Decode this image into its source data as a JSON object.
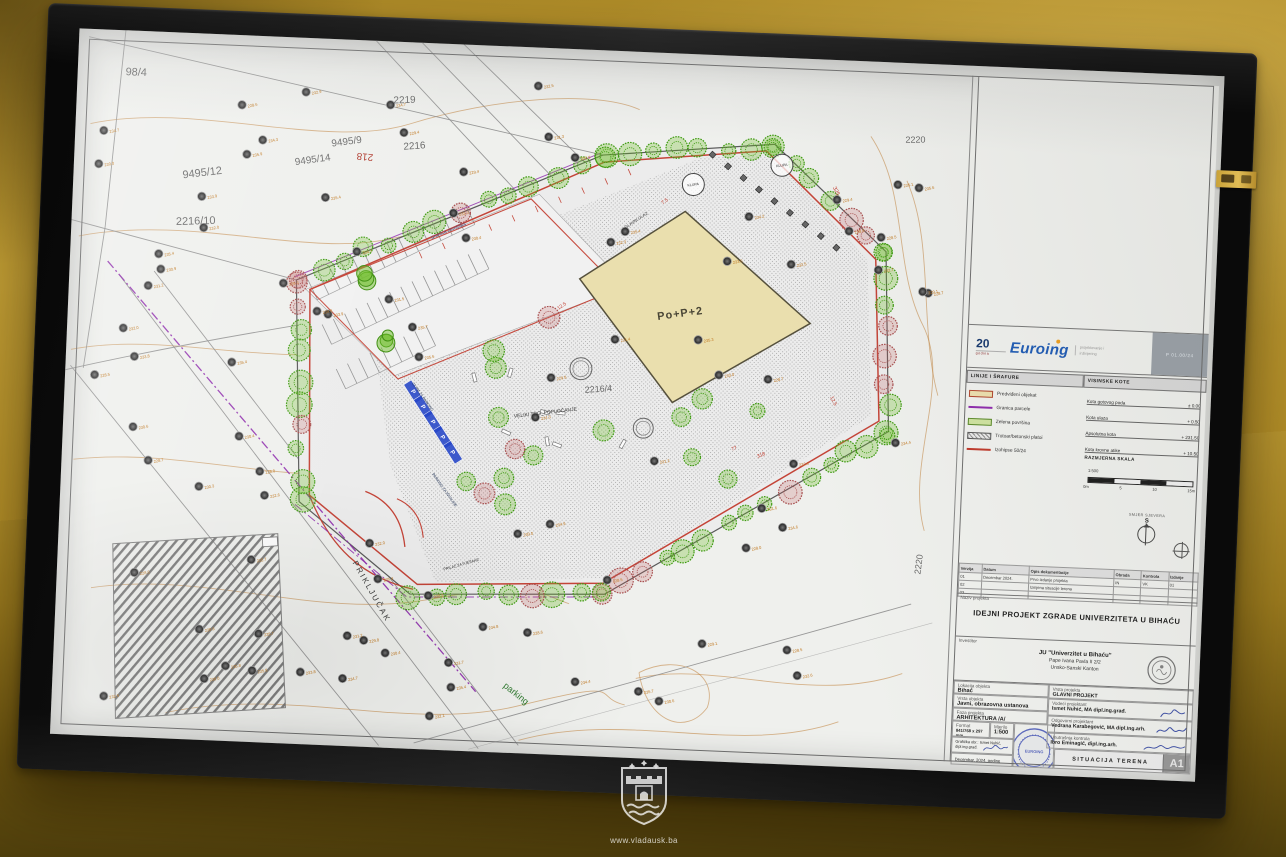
{
  "photo": {
    "watermark_url": "www.vladausk.ba"
  },
  "plan": {
    "building_label": "Po+P+2",
    "labels": [
      {
        "t": "98/4",
        "x": 48,
        "y": 45,
        "r": 0,
        "s": 11,
        "c": "#6a6a6a"
      },
      {
        "t": "2219",
        "x": 318,
        "y": 62,
        "r": -4,
        "s": 10,
        "c": "#6a6a6a"
      },
      {
        "t": "9495/9",
        "x": 258,
        "y": 108,
        "r": -10,
        "s": 10,
        "c": "#6a6a6a"
      },
      {
        "t": "218",
        "x": 300,
        "y": 114,
        "r": 183,
        "s": 10,
        "c": "#b03a2e"
      },
      {
        "t": "2216",
        "x": 330,
        "y": 108,
        "r": -6,
        "s": 10,
        "c": "#6a6a6a"
      },
      {
        "t": "9495/14",
        "x": 222,
        "y": 128,
        "r": -10,
        "s": 10,
        "c": "#6a6a6a"
      },
      {
        "t": "9495/12",
        "x": 110,
        "y": 146,
        "r": -9,
        "s": 11,
        "c": "#6a6a6a"
      },
      {
        "t": "2216/10",
        "x": 105,
        "y": 193,
        "r": -4,
        "s": 11,
        "c": "#6a6a6a"
      },
      {
        "t": "2216/4",
        "x": 522,
        "y": 344,
        "r": -6,
        "s": 9,
        "c": "#6a6a6a"
      },
      {
        "t": "2220",
        "x": 833,
        "y": 80,
        "r": -3,
        "s": 9,
        "c": "#6a6a6a"
      },
      {
        "t": "2220",
        "x": 866,
        "y": 512,
        "r": -85,
        "s": 9,
        "c": "#6a6a6a"
      },
      {
        "t": "PRIKLJUČAK",
        "x": 296,
        "y": 524,
        "r": 58,
        "s": 8,
        "c": "#3c3c3c",
        "ls": 2
      },
      {
        "t": "parking",
        "x": 452,
        "y": 642,
        "r": 36,
        "s": 9,
        "c": "#2f7a2f"
      },
      {
        "t": "VELIKI TRG_POPLOČANJE",
        "x": 452,
        "y": 372,
        "r": -9,
        "s": 5,
        "c": "#3a3a3a"
      },
      {
        "t": "KLUPA",
        "x": 622,
        "y": 132,
        "r": -10,
        "s": 3.6,
        "c": "#333333",
        "circ": 11
      },
      {
        "t": "KLUPA",
        "x": 710,
        "y": 109,
        "r": -10,
        "s": 3.6,
        "c": "#333333",
        "circ": 11
      },
      {
        "t": "granica zemljišta",
        "x": 362,
        "y": 196,
        "r": -24,
        "s": 5,
        "c": "#5a4a7a"
      },
      {
        "t": "PARKING ZA INVALIDE",
        "x": 372,
        "y": 432,
        "r": 52,
        "s": 3.8,
        "c": "#223355"
      },
      {
        "t": "23 PM ZA PARKING",
        "x": 348,
        "y": 342,
        "r": 52,
        "s": 3.8,
        "c": "#223355"
      },
      {
        "t": "PRILAZ ZA PJEŠAKE",
        "x": 388,
        "y": 528,
        "r": -18,
        "s": 3.8,
        "c": "#333333"
      },
      {
        "t": "GLAVNI ULAZ",
        "x": 556,
        "y": 178,
        "r": -36,
        "s": 4.2,
        "c": "#333333"
      },
      {
        "t": "12.5",
        "x": 492,
        "y": 262,
        "r": -36,
        "s": 5,
        "c": "#c0392b"
      },
      {
        "t": "12.5",
        "x": 768,
        "y": 338,
        "r": 62,
        "s": 5,
        "c": "#c0392b"
      },
      {
        "t": "325",
        "x": 762,
        "y": 128,
        "r": 62,
        "s": 5.5,
        "c": "#c0392b"
      },
      {
        "t": "318",
        "x": 698,
        "y": 402,
        "r": -24,
        "s": 5,
        "c": "#c0392b"
      },
      {
        "t": "77",
        "x": 672,
        "y": 396,
        "r": -24,
        "s": 5,
        "c": "#c0392b"
      },
      {
        "t": "7.5",
        "x": 592,
        "y": 152,
        "r": -36,
        "s": 5,
        "c": "#c0392b"
      },
      {
        "t": "Po+P+2",
        "x": 592,
        "y": 268,
        "r": -10,
        "s": 11,
        "c": "#4a4636",
        "w": "bold",
        "ls": 1
      }
    ]
  },
  "titleblock": {
    "logo": {
      "years": "20",
      "years_caption": "godina",
      "brand": "Euroing",
      "tagline_line1": "projektovanje i",
      "tagline_line2": "inžinjering",
      "doc_no": "P 01.00/24"
    },
    "legend": {
      "header": "LINIJE I ŠRAFURE",
      "items": [
        {
          "label": "Predviđeni objekat",
          "swatch": "building"
        },
        {
          "label": "Granica parcele",
          "swatch": "purple-line"
        },
        {
          "label": "Zelena površina",
          "swatch": "green"
        },
        {
          "label": "Trotoar/betonski platoi",
          "swatch": "hatch"
        },
        {
          "label": "Izohipse 50/24",
          "swatch": "red-line"
        }
      ]
    },
    "kote": {
      "header": "VISINSKE KOTE",
      "rows": [
        {
          "label": "Kota gotovog poda",
          "value": "± 0.00"
        },
        {
          "label": "Kota ulaza",
          "value": "+ 0.50"
        },
        {
          "label": "Apsolutna kota",
          "value": "+ 231.50"
        },
        {
          "label": "Kota krovne atike",
          "value": "+ 10.50"
        }
      ],
      "scale_header": "RAZMJERNA SKALA",
      "ratio": "1:500",
      "ticks": [
        "0m",
        "5",
        "10",
        "15m"
      ]
    },
    "north": {
      "caption": "SMJER SJEVERA",
      "letter": "S"
    },
    "revisions": {
      "headers": [
        "Verzija",
        "Datum",
        "Opis dokumentacije",
        "Obrada",
        "Kontrola",
        "Izdanje"
      ],
      "rows": [
        [
          "01",
          "Decembar 2024.",
          "Prvo izdanje projekta",
          "IN",
          "VK",
          "01"
        ],
        [
          "02",
          "",
          "Izmjena situacije terena",
          "",
          "",
          ""
        ],
        [
          "03",
          "",
          "",
          "",
          "",
          ""
        ]
      ]
    },
    "project": {
      "caption": "Naziv projekta",
      "title": "IDEJNI PROJEKT ZGRADE UNIVERZITETA U BIHAĆU"
    },
    "investor": {
      "caption": "Investitor",
      "line1": "JU \"Univerzitet u Bihaću\"",
      "line2": "Pape Ivana Pavla II 2/2",
      "line3": "Unsko-Sanski Kanton"
    },
    "left": {
      "lokacija_label": "Lokacija objekta",
      "lokacija": "Bihać",
      "vrsta_label": "Vrsta objekta",
      "vrsta": "Javni, obrazovna ustanova",
      "faza_label": "Faza projekta",
      "faza": "ARHITEKTURA /A/",
      "format_label": "Format",
      "format": "841/768 x 297 mm",
      "mjerilo_label": "Mjerilo",
      "mjerilo": "1:500",
      "grafika": "Grafička obr.: Ismet Nuhić, dipl.ing.građ.",
      "datum": "Decembar, 2024. godine"
    },
    "right": {
      "r1_label": "Vrsta projekta",
      "r1": "GLAVNI PROJEKT",
      "r2_label": "Vodeći projektant",
      "r2": "Ismet Nuhić, MA dipl.ing.građ.",
      "r3_label": "Odgovorni projektant",
      "r3": "Vedrana Karabegović, MA dipl.ing.arh.",
      "r4_label": "Unutrašnja kontrola",
      "r4": "Ibro Eminagić, dipl.ing.arh."
    },
    "sheet": {
      "title": "SITUACIJA TERENA",
      "format": "A1"
    }
  }
}
